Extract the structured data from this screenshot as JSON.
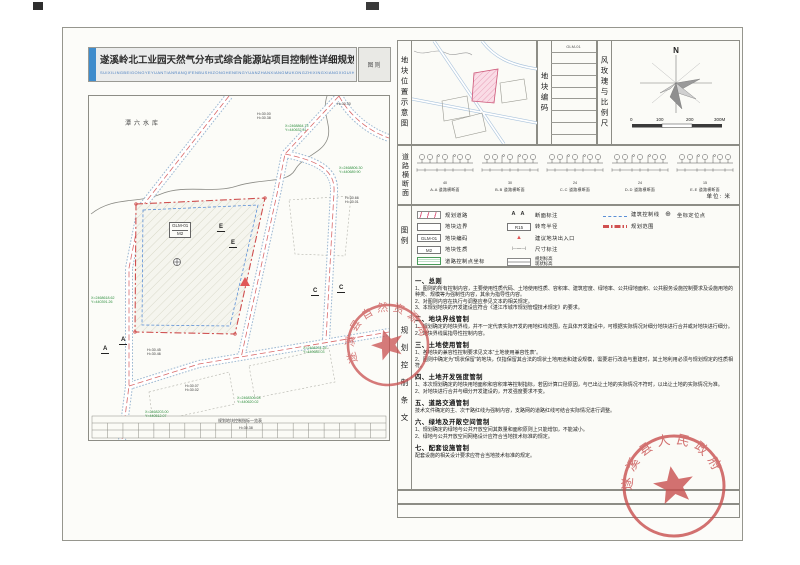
{
  "title": {
    "text": "遂溪岭北工业园天然气分布式综合能源站项目控制性详细规划",
    "pinyin": "SUIXILINGBEIGONGYEYUANTIANRANQIFENBUSHIZONGHENENGYUANZHANXIANGMUKONGZHIXINGXIANGXIGUIHUA",
    "side_box": "图则",
    "accent_color": "#3f8ccc"
  },
  "map": {
    "lake_label": "潭六水库",
    "parcel": {
      "code": "GLM-01",
      "use": "M2"
    },
    "table_title": "规划地块控制指标一览表",
    "section_letters": [
      {
        "t": "A",
        "x": 12,
        "y": 250
      },
      {
        "t": "A",
        "x": 30,
        "y": 241
      },
      {
        "t": "C",
        "x": 222,
        "y": 192
      },
      {
        "t": "C",
        "x": 248,
        "y": 189
      },
      {
        "t": "E",
        "x": 128,
        "y": 128
      },
      {
        "t": "E",
        "x": 140,
        "y": 144
      }
    ],
    "green_annotations": [
      {
        "l1": "X=2468864.75",
        "l2": "Y=440632.51",
        "x": 196,
        "y": 28
      },
      {
        "l1": "X=2468806.30",
        "l2": "Y=440689.90",
        "x": 250,
        "y": 70
      },
      {
        "l1": "X=2468618.62",
        "l2": "Y=440391.26",
        "x": 2,
        "y": 200
      },
      {
        "l1": "X=2468231.25",
        "l2": "Y=440685.03",
        "x": 214,
        "y": 250
      },
      {
        "l1": "X=2468203.00",
        "l2": "Y=440512.07",
        "x": 56,
        "y": 314
      },
      {
        "l1": "X=2468306.28",
        "l2": "Y=440620.02",
        "x": 148,
        "y": 300
      }
    ],
    "black_annotations": [
      {
        "l1": "H=30.00",
        "l2": "H=30.38",
        "x": 168,
        "y": 16
      },
      {
        "l1": "H=30.30",
        "l2": "",
        "x": 248,
        "y": 6
      },
      {
        "l1": "H=30.66",
        "l2": "H=30.01",
        "x": 256,
        "y": 100
      },
      {
        "l1": "H=30.45",
        "l2": "H=30.46",
        "x": 58,
        "y": 252
      },
      {
        "l1": "H=30.07",
        "l2": "H=30.02",
        "x": 96,
        "y": 288
      },
      {
        "l1": "H=30.38",
        "l2": "",
        "x": 150,
        "y": 330
      }
    ]
  },
  "location_panel": {
    "label": "地块位置示意图"
  },
  "code_panel": {
    "label": "地块编码",
    "rows": [
      "GLM-01",
      "",
      "",
      "",
      "",
      "",
      "",
      ""
    ]
  },
  "compass_panel": {
    "label": "风玫瑰与比例尺",
    "north": "N",
    "scale_ticks": [
      "0",
      "100",
      "200",
      "300M"
    ]
  },
  "sections_panel": {
    "label": "道路横断面",
    "unit": "单位: 米",
    "sections": [
      {
        "name": "A-A 道路横断面",
        "total": "40"
      },
      {
        "name": "B-B 道路横断面",
        "total": "30"
      },
      {
        "name": "C-C 道路横断面",
        "total": "24"
      },
      {
        "name": "D-D 道路横断面",
        "total": "24"
      },
      {
        "name": "E-E 道路横断面",
        "total": "15"
      }
    ]
  },
  "legend_panel": {
    "label": "图例",
    "entries": [
      {
        "type": "road",
        "sym": "",
        "label": "规划道路",
        "col": 0,
        "row": 0
      },
      {
        "type": "rect",
        "sym": "",
        "label": "地块边界",
        "col": 0,
        "row": 1
      },
      {
        "type": "code",
        "sym": "GLM-01",
        "label": "地块编码",
        "col": 0,
        "row": 2
      },
      {
        "type": "use",
        "sym": "M2",
        "label": "地块性质",
        "col": 0,
        "row": 3
      },
      {
        "type": "coord",
        "sym": "",
        "label": "道路控制点坐标",
        "col": 0,
        "row": 4
      },
      {
        "type": "secmark",
        "sym": "A A",
        "label": "断面标注",
        "col": 1,
        "row": 0
      },
      {
        "type": "radius",
        "sym": "R15",
        "label": "转弯半径",
        "col": 1,
        "row": 1
      },
      {
        "type": "entry",
        "sym": "▲",
        "label": "建议地块出入口",
        "col": 1,
        "row": 2
      },
      {
        "type": "dim",
        "sym": "⊢—⊣",
        "label": "尺寸标注",
        "col": 1,
        "row": 3
      },
      {
        "type": "elev",
        "sym": "",
        "label": "规划标高",
        "label2": "现状标高",
        "col": 1,
        "row": 4
      },
      {
        "type": "bcl",
        "sym": "",
        "label": "建筑控制线",
        "col": 2,
        "row": 0
      },
      {
        "type": "scope",
        "sym": "",
        "label": "规划范围",
        "col": 2,
        "row": 1
      },
      {
        "type": "point",
        "sym": "⊕",
        "label": "坐标定位点",
        "col": 3,
        "row": 0
      }
    ]
  },
  "notes_panel": {
    "label": "规划控制条文",
    "lines": [
      {
        "h": "一、总则"
      },
      {
        "p": "1、图则的所有控制内容，主要使用性质代码、土地使用性质、容积率、建筑密度、绿地率、公共绿地面积、公共服务设施控制要求及设施用地的种类、规模等为强制性内容，其余为指导性内容。"
      },
      {
        "p": "2、对图则内容在执行与调整应参见文本的相关规定。"
      },
      {
        "p": "3、本规划地块的开发建设应符合《湛江市城市规划管理技术规定》的要求。"
      },
      {
        "h": "二、地块界线管制"
      },
      {
        "p": "1、规划确定的地块界线，并不一定代表实际开发的用地红线范围，在具体开发建设中，可根据实际情况对细分地块进行合并或对地块进行细分。"
      },
      {
        "p": "2、地块界线属指导性控制内容。"
      },
      {
        "h": "三、土地使用管制"
      },
      {
        "p": "1、各地块的兼容性控制要求见文本“土地使用兼容性表”。"
      },
      {
        "p": "2、图则中确定为“现状保留”的地块，仅指保留其合法的现状土地用途和建设规模，需要进行改造与重建时，其土地利用必须与规划规定的性质相符。"
      },
      {
        "h": "四、土地开发强度管制"
      },
      {
        "p": "1、本次规划确定的地块用地面积和容积率等控制指标，若因计算口径原因，与已出让土地的实际情况不符时，以出让土地的实际情况为准。"
      },
      {
        "p": "2、对地块进行合并与细分开发建设的，开发强度要求不变。"
      },
      {
        "h": "五、道路交通管制"
      },
      {
        "p": "技术文件确定的主、次干路红线为强制内容，支路网的道路红线可结合实际情况进行调整。"
      },
      {
        "h": "六、绿地及开敞空间管制"
      },
      {
        "p": "1、规划确定的绿地与公共开放空间其数量和面积原则上只能增加，不能减小。"
      },
      {
        "p": "2、绿地与公共开放空间网络设计应符合当地技术标准的规定。"
      },
      {
        "h": "七、配套设施管制"
      },
      {
        "p": "配套设施的相关设计要求应符合当地技术标准的规定。"
      }
    ]
  },
  "seals": [
    {
      "ring": "遂溪县自然资源局",
      "color": "#c84f4f"
    },
    {
      "ring": "遂溪县人民政府",
      "color": "#c84f4f"
    }
  ],
  "colors": {
    "road_edge": "#9cb8d2",
    "road_center": "#d96a6a",
    "parcel_boundary": "#cf4f4f",
    "building_control": "#5b8fd6",
    "coordinate_green": "#2f8f3f",
    "minimap_parcel": "#e8a0b8"
  }
}
